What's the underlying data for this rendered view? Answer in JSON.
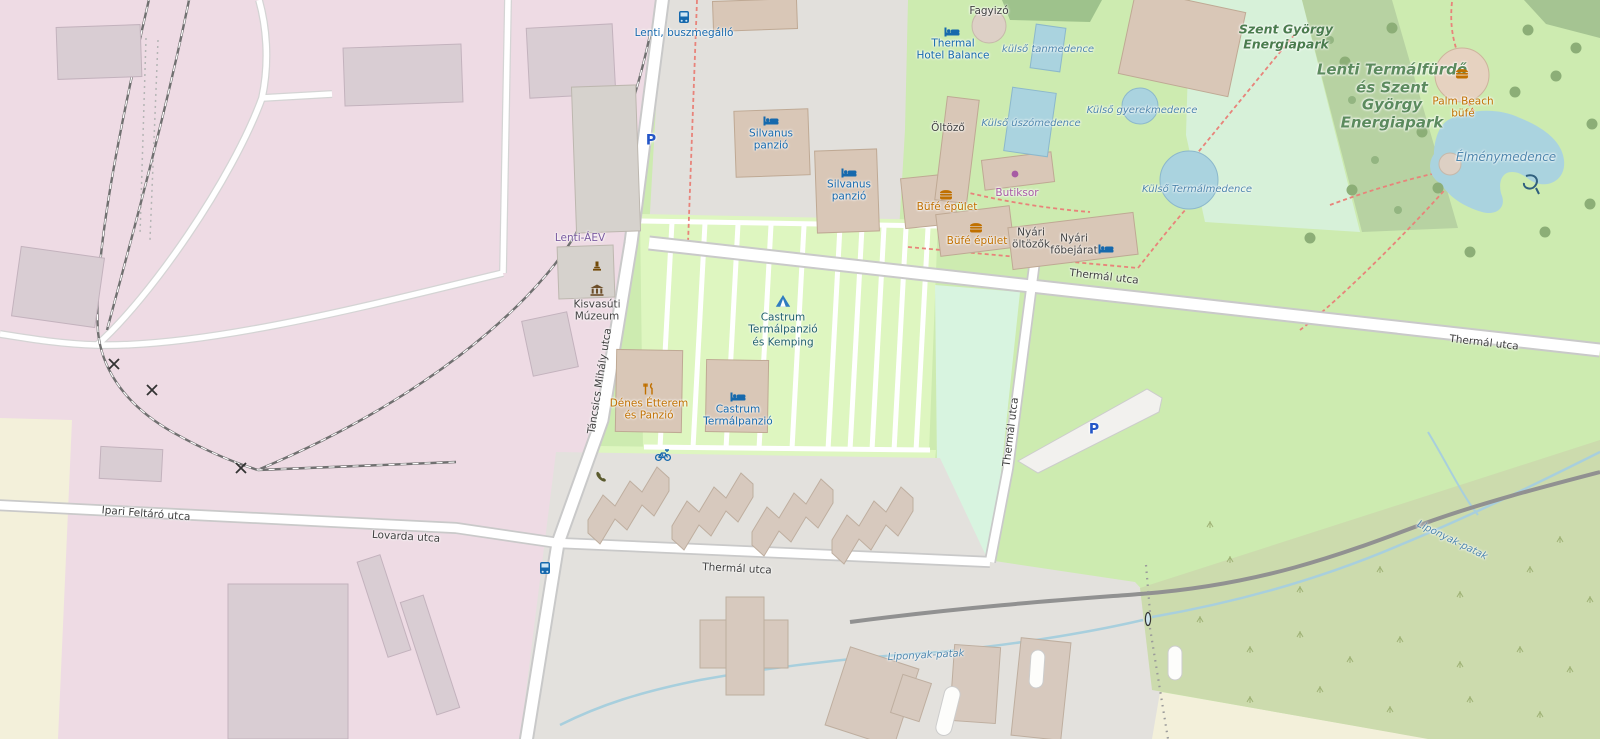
{
  "colors": {
    "grass": "#cdebb0",
    "pink-railway-landuse": "#eedbe4",
    "residential-gray": "#e1dfdc",
    "camp-green": "#def6c0",
    "mint-park": "#d7f1d9",
    "scrub": "#ccdbad",
    "farmland": "#f3f0da",
    "water": "#aad3df",
    "forest-band": "#b7d2a2",
    "road-fill": "#ffffff",
    "road-casing": "#c9c9c9",
    "railway-gray": "#707070",
    "building-tan": "#d9c7b7",
    "poi-blue": "#1669ad",
    "poi-orange": "#c07000",
    "poi-purple": "#a75ba4",
    "camp-label": "#20606e",
    "station-purple": "#7a5aa0",
    "parking-blue": "#2456c7",
    "water-label": "#4e86ad",
    "path-red": "#e8837a"
  },
  "labels": [
    {
      "id": "thermal-utca-top",
      "cls": "street",
      "x": 1104,
      "y": 277,
      "rot": 6.5,
      "lines": [
        "Thermál utca"
      ]
    },
    {
      "id": "thermal-utca-right",
      "cls": "street",
      "x": 1484,
      "y": 343,
      "rot": 6.5,
      "lines": [
        "Thermál utca"
      ]
    },
    {
      "id": "thermal-utca-vertical",
      "cls": "street",
      "x": 1011,
      "y": 432,
      "rot": -83,
      "lines": [
        "Thermál utca"
      ]
    },
    {
      "id": "thermal-utca-bottom",
      "cls": "street",
      "x": 737,
      "y": 569,
      "rot": 3,
      "lines": [
        "Thermál utca"
      ]
    },
    {
      "id": "lovarda-utca",
      "cls": "street",
      "x": 406,
      "y": 537,
      "rot": 3.5,
      "lines": [
        "Lovarda utca"
      ]
    },
    {
      "id": "ipari-feltaro-utca",
      "cls": "street",
      "x": 146,
      "y": 514,
      "rot": 4.5,
      "lines": [
        "Ipari Feltáró utca"
      ]
    },
    {
      "id": "tancsics-mihaly-utca",
      "cls": "street",
      "x": 600,
      "y": 381,
      "rot": -81,
      "lines": [
        "Táncsics Mihály utca"
      ]
    },
    {
      "id": "lenti-buszmegallo",
      "cls": "poi",
      "x": 684,
      "y": 33,
      "rot": 0,
      "lines": [
        "Lenti, buszmegálló"
      ]
    },
    {
      "id": "thermal-hotel-balance",
      "cls": "poi",
      "x": 953,
      "y": 50,
      "rot": 0,
      "lines": [
        "Thermal",
        "Hotel Balance"
      ]
    },
    {
      "id": "silvanus-panzio-1",
      "cls": "poi",
      "x": 771,
      "y": 140,
      "rot": 0,
      "lines": [
        "Silvanus",
        "panzió"
      ]
    },
    {
      "id": "silvanus-panzio-2",
      "cls": "poi",
      "x": 849,
      "y": 191,
      "rot": 0,
      "lines": [
        "Silvanus",
        "panzió"
      ]
    },
    {
      "id": "castrum-termalpanzio",
      "cls": "poi",
      "x": 738,
      "y": 416,
      "rot": 0,
      "lines": [
        "Castrum",
        "Termálpanzió"
      ]
    },
    {
      "id": "parking-north",
      "cls": "parking",
      "x": 651,
      "y": 141,
      "rot": 0,
      "lines": [
        "P"
      ]
    },
    {
      "id": "parking-mid",
      "cls": "parking",
      "x": 1094,
      "y": 430,
      "rot": 0,
      "lines": [
        "P"
      ]
    },
    {
      "id": "lenti-aev",
      "cls": "station",
      "x": 580,
      "y": 238,
      "rot": 0,
      "lines": [
        "Lenti-ÁEV"
      ]
    },
    {
      "id": "castrum-kemping",
      "cls": "camp",
      "x": 783,
      "y": 330,
      "rot": 0,
      "lines": [
        "Castrum",
        "Termálpanzió",
        "és Kemping"
      ]
    },
    {
      "id": "fagyizo",
      "cls": "dark",
      "x": 989,
      "y": 11,
      "rot": 0,
      "lines": [
        "Fagyizó"
      ]
    },
    {
      "id": "oltozo",
      "cls": "dark",
      "x": 948,
      "y": 128,
      "rot": 0,
      "lines": [
        "Öltöző"
      ]
    },
    {
      "id": "nyari-oltozok",
      "cls": "dark",
      "x": 1031,
      "y": 239,
      "rot": 0,
      "lines": [
        "Nyári",
        "öltözők"
      ]
    },
    {
      "id": "nyari-fobejarat",
      "cls": "dark",
      "x": 1074,
      "y": 245,
      "rot": 0,
      "lines": [
        "Nyári",
        "főbejárat"
      ]
    },
    {
      "id": "kisvasuti-muzeum",
      "cls": "dark",
      "x": 597,
      "y": 311,
      "rot": 0,
      "lines": [
        "Kisvasúti",
        "Múzeum"
      ]
    },
    {
      "id": "bufe-epulet-1",
      "cls": "orange",
      "x": 947,
      "y": 207,
      "rot": 0,
      "lines": [
        "Büfé épület"
      ]
    },
    {
      "id": "bufe-epulet-2",
      "cls": "orange",
      "x": 977,
      "y": 241,
      "rot": 0,
      "lines": [
        "Büfé épület"
      ]
    },
    {
      "id": "palm-beach-bufe",
      "cls": "orange",
      "x": 1463,
      "y": 108,
      "rot": 0,
      "lines": [
        "Palm Beach",
        "büfé"
      ]
    },
    {
      "id": "denes-etterem",
      "cls": "orange",
      "x": 649,
      "y": 410,
      "rot": 0,
      "lines": [
        "Dénes Étterem",
        "és Panzió"
      ]
    },
    {
      "id": "butiksor",
      "cls": "purple",
      "x": 1017,
      "y": 193,
      "rot": 0,
      "lines": [
        "Butiksor"
      ]
    },
    {
      "id": "szent-gyorgy-energiapark",
      "cls": "green-area",
      "x": 1286,
      "y": 37,
      "rot": 0,
      "size": 12.5,
      "lines": [
        "Szent György",
        "Energiapark"
      ]
    },
    {
      "id": "lenti-termalfurdo-energiapark",
      "cls": "big-green",
      "x": 1392,
      "y": 97,
      "rot": 0,
      "size": 15,
      "lines": [
        "Lenti Termálfürdő",
        "és Szent",
        "György",
        "Energiapark"
      ]
    },
    {
      "id": "kulso-tanmedence",
      "cls": "water",
      "x": 1048,
      "y": 50,
      "rot": 0,
      "lines": [
        "külső tanmedence"
      ]
    },
    {
      "id": "kulso-uszomedence",
      "cls": "water",
      "x": 1031,
      "y": 124,
      "rot": 0,
      "lines": [
        "Külső úszómedence"
      ]
    },
    {
      "id": "kulso-gyerekmedence",
      "cls": "water",
      "x": 1142,
      "y": 111,
      "rot": 0,
      "lines": [
        "Külső gyerekmedence"
      ]
    },
    {
      "id": "kulso-termalmedence",
      "cls": "water",
      "x": 1197,
      "y": 190,
      "rot": 0,
      "lines": [
        "Külső Termálmedence"
      ]
    },
    {
      "id": "elmenymedence",
      "cls": "water",
      "x": 1506,
      "y": 157,
      "rot": 0,
      "size": 12,
      "lines": [
        "Élménymedence"
      ]
    },
    {
      "id": "liponyak-patak-east",
      "cls": "water",
      "x": 1452,
      "y": 541,
      "rot": 26,
      "lines": [
        "Liponyak-patak"
      ]
    },
    {
      "id": "liponyak-patak-south",
      "cls": "water",
      "x": 926,
      "y": 656,
      "rot": -3,
      "lines": [
        "Liponyak-patak"
      ]
    }
  ],
  "icons": [
    {
      "type": "bus",
      "x": 684,
      "y": 17
    },
    {
      "type": "bus",
      "x": 545,
      "y": 568
    },
    {
      "type": "bed",
      "x": 952,
      "y": 32
    },
    {
      "type": "bed",
      "x": 771,
      "y": 121
    },
    {
      "type": "bed",
      "x": 849,
      "y": 173
    },
    {
      "type": "bed",
      "x": 738,
      "y": 397
    },
    {
      "type": "bed",
      "x": 1106,
      "y": 249
    },
    {
      "type": "tent",
      "x": 783,
      "y": 301
    },
    {
      "type": "burger",
      "x": 946,
      "y": 194
    },
    {
      "type": "burger",
      "x": 976,
      "y": 227
    },
    {
      "type": "burger",
      "x": 1462,
      "y": 73
    },
    {
      "type": "fork-knife",
      "x": 649,
      "y": 389
    },
    {
      "type": "museum",
      "x": 597,
      "y": 290
    },
    {
      "type": "monument",
      "x": 597,
      "y": 266
    },
    {
      "type": "shop-dot",
      "x": 1015,
      "y": 174
    },
    {
      "type": "bike-rental",
      "x": 663,
      "y": 455
    },
    {
      "type": "phone",
      "x": 601,
      "y": 477
    }
  ]
}
